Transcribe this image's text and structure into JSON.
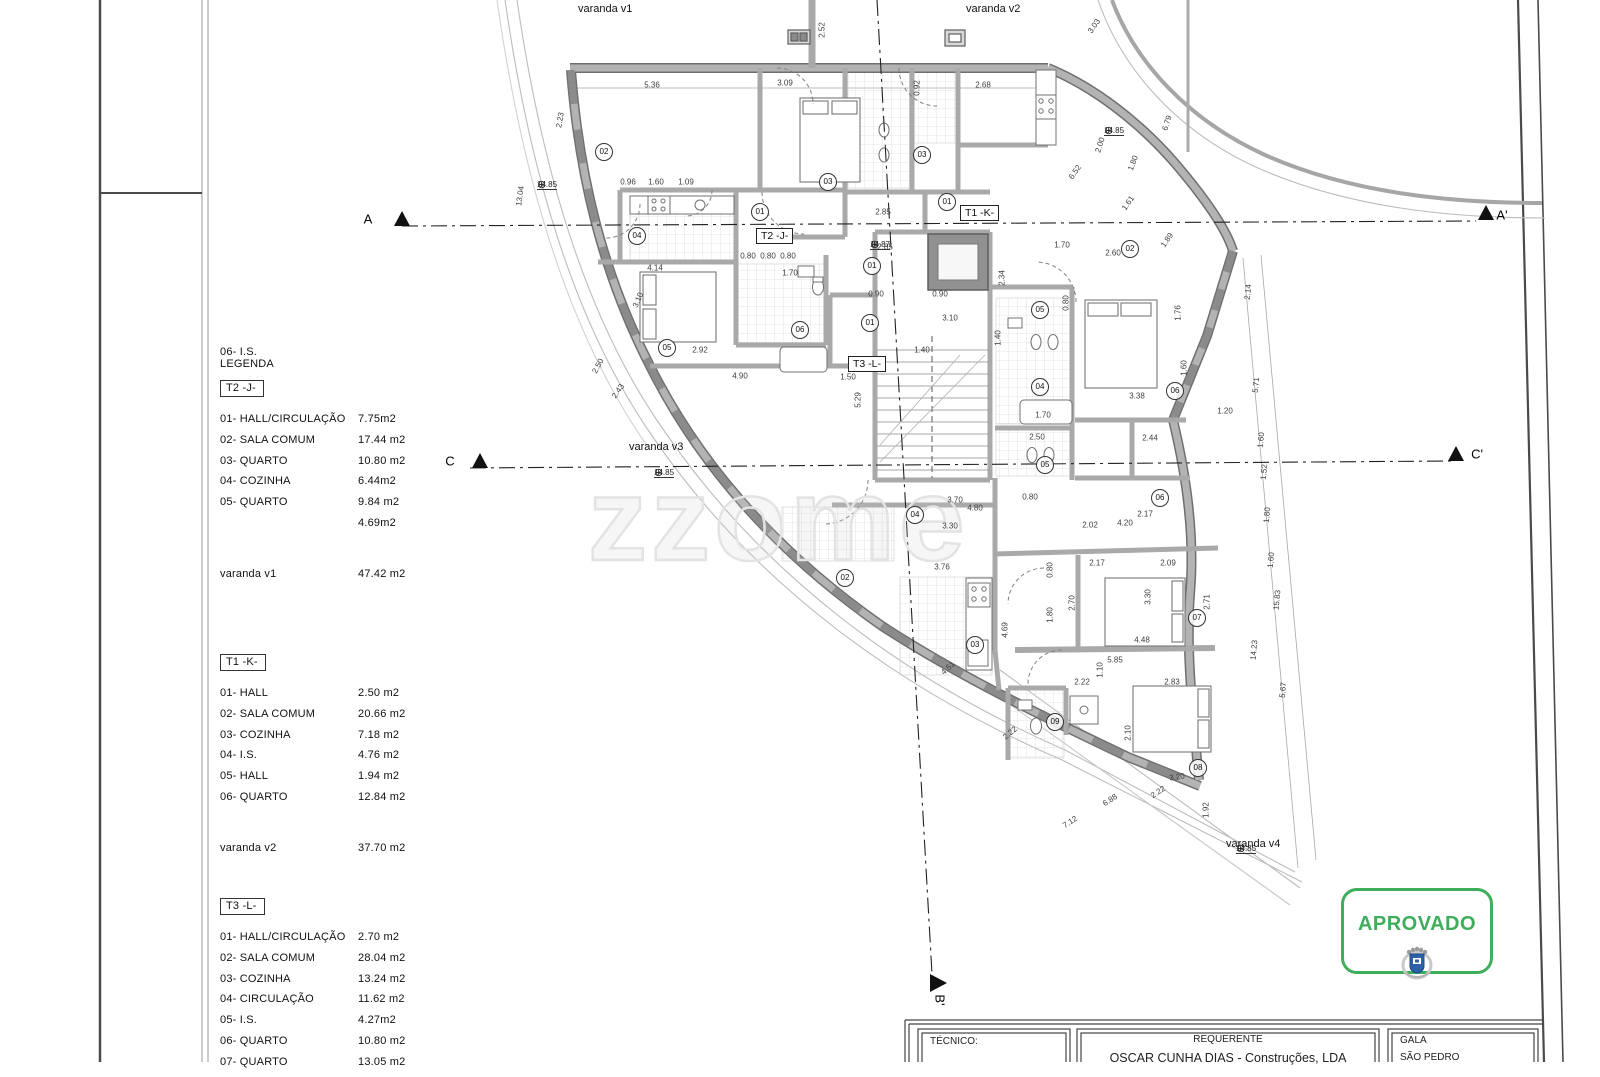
{
  "legend": {
    "pre_note": "06- I.S.",
    "title": "LEGENDA",
    "sections": [
      {
        "tag": "T2 -J-",
        "rows": [
          {
            "label": "01- HALL/CIRCULAÇÃO",
            "value": "7.75m2"
          },
          {
            "label": "02- SALA COMUM",
            "value": "17.44 m2"
          },
          {
            "label": "03- QUARTO",
            "value": "10.80 m2"
          },
          {
            "label": "04- COZINHA",
            "value": "6.44m2"
          },
          {
            "label": "05- QUARTO",
            "value": "9.84 m2"
          },
          {
            "label": "",
            "value": "4.69m2"
          }
        ],
        "varanda": {
          "label": "varanda v1",
          "value": "47.42 m2"
        }
      },
      {
        "tag": "T1 -K-",
        "rows": [
          {
            "label": "01- HALL",
            "value": "2.50 m2"
          },
          {
            "label": "02- SALA COMUM",
            "value": "20.66 m2"
          },
          {
            "label": "03- COZINHA",
            "value": "7.18 m2"
          },
          {
            "label": "04- I.S.",
            "value": "4.76 m2"
          },
          {
            "label": "05- HALL",
            "value": "1.94 m2"
          },
          {
            "label": "06- QUARTO",
            "value": "12.84 m2"
          }
        ],
        "varanda": {
          "label": "varanda v2",
          "value": "37.70 m2"
        }
      },
      {
        "tag": "T3 -L-",
        "rows": [
          {
            "label": "01- HALL/CIRCULAÇÃO",
            "value": "2.70 m2"
          },
          {
            "label": "02- SALA COMUM",
            "value": "28.04 m2"
          },
          {
            "label": "03- COZINHA",
            "value": "13.24 m2"
          },
          {
            "label": "04- CIRCULAÇÃO",
            "value": "11.62 m2"
          },
          {
            "label": "05- I.S.",
            "value": "4.27m2"
          },
          {
            "label": "06- QUARTO",
            "value": "10.80 m2"
          },
          {
            "label": "07- QUARTO",
            "value": "13.05 m2"
          }
        ],
        "varanda": null
      }
    ]
  },
  "plan": {
    "unit_tags": [
      {
        "text": "T2 -J-",
        "x": 756,
        "y": 228
      },
      {
        "text": "T1 -K-",
        "x": 960,
        "y": 205
      },
      {
        "text": "T3 -L-",
        "x": 848,
        "y": 356
      }
    ],
    "balconies": [
      {
        "text": "varanda v1",
        "x": 578,
        "y": 3
      },
      {
        "text": "varanda v2",
        "x": 966,
        "y": 3
      },
      {
        "text": "varanda v3",
        "x": 629,
        "y": 441
      },
      {
        "text": "varanda v4",
        "x": 1226,
        "y": 838
      }
    ],
    "levels": [
      {
        "value": "14.85",
        "x": 545,
        "y": 190
      },
      {
        "value": "14.87",
        "x": 878,
        "y": 250
      },
      {
        "value": "14.85",
        "x": 662,
        "y": 478
      },
      {
        "value": "14.85",
        "x": 1112,
        "y": 136
      },
      {
        "value": "14.85",
        "x": 1244,
        "y": 854
      }
    ],
    "section_markers": [
      {
        "text": "A",
        "x": 368,
        "y": 219,
        "rot": 0
      },
      {
        "text": "A'",
        "x": 1502,
        "y": 215,
        "rot": 0
      },
      {
        "text": "C",
        "x": 450,
        "y": 461,
        "rot": 0
      },
      {
        "text": "C'",
        "x": 1477,
        "y": 454,
        "rot": 0
      },
      {
        "text": "B'",
        "x": 940,
        "y": 1000,
        "rot": 90
      }
    ],
    "rooms": [
      {
        "n": "02",
        "x": 604,
        "y": 152
      },
      {
        "n": "03",
        "x": 828,
        "y": 182
      },
      {
        "n": "03",
        "x": 922,
        "y": 155
      },
      {
        "n": "01",
        "x": 760,
        "y": 212
      },
      {
        "n": "01",
        "x": 947,
        "y": 202
      },
      {
        "n": "01",
        "x": 872,
        "y": 266
      },
      {
        "n": "01",
        "x": 870,
        "y": 323
      },
      {
        "n": "04",
        "x": 637,
        "y": 236
      },
      {
        "n": "05",
        "x": 667,
        "y": 348
      },
      {
        "n": "06",
        "x": 800,
        "y": 330
      },
      {
        "n": "02",
        "x": 1130,
        "y": 249
      },
      {
        "n": "05",
        "x": 1040,
        "y": 310
      },
      {
        "n": "04",
        "x": 1040,
        "y": 387
      },
      {
        "n": "06",
        "x": 1175,
        "y": 391
      },
      {
        "n": "05",
        "x": 1045,
        "y": 465
      },
      {
        "n": "06",
        "x": 1160,
        "y": 498
      },
      {
        "n": "04",
        "x": 915,
        "y": 515
      },
      {
        "n": "02",
        "x": 845,
        "y": 578
      },
      {
        "n": "03",
        "x": 975,
        "y": 645
      },
      {
        "n": "07",
        "x": 1197,
        "y": 618
      },
      {
        "n": "09",
        "x": 1055,
        "y": 722
      },
      {
        "n": "08",
        "x": 1198,
        "y": 768
      }
    ],
    "dimensions": [
      {
        "t": "5.36",
        "x": 652,
        "y": 85,
        "r": 0
      },
      {
        "t": "3.09",
        "x": 785,
        "y": 83,
        "r": 0
      },
      {
        "t": "2.68",
        "x": 983,
        "y": 85,
        "r": 0
      },
      {
        "t": "2.52",
        "x": 822,
        "y": 30,
        "r": -90
      },
      {
        "t": "0.92",
        "x": 917,
        "y": 88,
        "r": -90
      },
      {
        "t": "2.85",
        "x": 883,
        "y": 212,
        "r": 0
      },
      {
        "t": "2.85",
        "x": 885,
        "y": 247,
        "r": 0
      },
      {
        "t": "0.96",
        "x": 628,
        "y": 182,
        "r": 0
      },
      {
        "t": "1.60",
        "x": 656,
        "y": 182,
        "r": 0
      },
      {
        "t": "1.09",
        "x": 686,
        "y": 182,
        "r": 0
      },
      {
        "t": "0.80",
        "x": 748,
        "y": 256,
        "r": 0
      },
      {
        "t": "0.80",
        "x": 768,
        "y": 256,
        "r": 0
      },
      {
        "t": "0.80",
        "x": 788,
        "y": 256,
        "r": 0
      },
      {
        "t": "1.70",
        "x": 790,
        "y": 273,
        "r": 0
      },
      {
        "t": "4.14",
        "x": 655,
        "y": 268,
        "r": 0
      },
      {
        "t": "2.92",
        "x": 700,
        "y": 350,
        "r": 0
      },
      {
        "t": "4.90",
        "x": 740,
        "y": 376,
        "r": 0
      },
      {
        "t": "1.50",
        "x": 848,
        "y": 377,
        "r": 0
      },
      {
        "t": "2.50",
        "x": 598,
        "y": 366,
        "r": -62
      },
      {
        "t": "2.43",
        "x": 618,
        "y": 391,
        "r": -55
      },
      {
        "t": "3.10",
        "x": 638,
        "y": 300,
        "r": -68
      },
      {
        "t": "2.23",
        "x": 560,
        "y": 120,
        "r": -80
      },
      {
        "t": "13.04",
        "x": 520,
        "y": 196,
        "r": -82
      },
      {
        "t": "5.29",
        "x": 858,
        "y": 400,
        "r": -90
      },
      {
        "t": "1.40",
        "x": 922,
        "y": 350,
        "r": 0
      },
      {
        "t": "3.10",
        "x": 950,
        "y": 318,
        "r": 0
      },
      {
        "t": "1.40",
        "x": 998,
        "y": 338,
        "r": -90
      },
      {
        "t": "0.90",
        "x": 876,
        "y": 294,
        "r": 0
      },
      {
        "t": "0.90",
        "x": 940,
        "y": 294,
        "r": 0
      },
      {
        "t": "3.70",
        "x": 955,
        "y": 500,
        "r": 0
      },
      {
        "t": "4.80",
        "x": 975,
        "y": 508,
        "r": 0
      },
      {
        "t": "3.30",
        "x": 950,
        "y": 526,
        "r": 0
      },
      {
        "t": "0.80",
        "x": 1030,
        "y": 497,
        "r": 0
      },
      {
        "t": "2.34",
        "x": 1002,
        "y": 278,
        "r": -90
      },
      {
        "t": "0.80",
        "x": 1066,
        "y": 303,
        "r": -90
      },
      {
        "t": "1.76",
        "x": 1178,
        "y": 313,
        "r": -90
      },
      {
        "t": "1.60",
        "x": 1184,
        "y": 368,
        "r": -90
      },
      {
        "t": "3.38",
        "x": 1137,
        "y": 396,
        "r": 0
      },
      {
        "t": "1.70",
        "x": 1043,
        "y": 415,
        "r": 0
      },
      {
        "t": "1.20",
        "x": 1225,
        "y": 411,
        "r": 0
      },
      {
        "t": "2.44",
        "x": 1150,
        "y": 438,
        "r": 0
      },
      {
        "t": "2.50",
        "x": 1037,
        "y": 437,
        "r": 0
      },
      {
        "t": "2.17",
        "x": 1145,
        "y": 514,
        "r": 0
      },
      {
        "t": "4.20",
        "x": 1125,
        "y": 523,
        "r": 0
      },
      {
        "t": "2.02",
        "x": 1090,
        "y": 525,
        "r": 0
      },
      {
        "t": "3.76",
        "x": 942,
        "y": 567,
        "r": 0
      },
      {
        "t": "2.17",
        "x": 1097,
        "y": 563,
        "r": 0
      },
      {
        "t": "2.09",
        "x": 1168,
        "y": 563,
        "r": 0
      },
      {
        "t": "3.30",
        "x": 1148,
        "y": 597,
        "r": -90
      },
      {
        "t": "2.70",
        "x": 1072,
        "y": 603,
        "r": -90
      },
      {
        "t": "1.80",
        "x": 1050,
        "y": 615,
        "r": -90
      },
      {
        "t": "0.80",
        "x": 1050,
        "y": 570,
        "r": -90
      },
      {
        "t": "4.48",
        "x": 1142,
        "y": 640,
        "r": 0
      },
      {
        "t": "5.85",
        "x": 1115,
        "y": 660,
        "r": 0
      },
      {
        "t": "2.22",
        "x": 1082,
        "y": 682,
        "r": 0
      },
      {
        "t": "2.83",
        "x": 1172,
        "y": 682,
        "r": 0
      },
      {
        "t": "1.10",
        "x": 1100,
        "y": 670,
        "r": -90
      },
      {
        "t": "2.10",
        "x": 1128,
        "y": 733,
        "r": -90
      },
      {
        "t": "3.20",
        "x": 1177,
        "y": 777,
        "r": -8
      },
      {
        "t": "2.71",
        "x": 1207,
        "y": 602,
        "r": -90
      },
      {
        "t": "4.51",
        "x": 948,
        "y": 668,
        "r": -42
      },
      {
        "t": "4.69",
        "x": 1005,
        "y": 630,
        "r": -90
      },
      {
        "t": "2.22",
        "x": 1010,
        "y": 733,
        "r": -40
      },
      {
        "t": "6.52",
        "x": 1075,
        "y": 172,
        "r": -55
      },
      {
        "t": "2.00",
        "x": 1100,
        "y": 145,
        "r": -72
      },
      {
        "t": "1.80",
        "x": 1133,
        "y": 163,
        "r": -70
      },
      {
        "t": "1.61",
        "x": 1128,
        "y": 203,
        "r": -55
      },
      {
        "t": "1.89",
        "x": 1167,
        "y": 240,
        "r": -55
      },
      {
        "t": "3.03",
        "x": 1094,
        "y": 26,
        "r": -55
      },
      {
        "t": "6.79",
        "x": 1167,
        "y": 123,
        "r": -72
      },
      {
        "t": "2.60",
        "x": 1113,
        "y": 253,
        "r": 0
      },
      {
        "t": "1.70",
        "x": 1062,
        "y": 245,
        "r": 0
      },
      {
        "t": "2.14",
        "x": 1248,
        "y": 292,
        "r": -85
      },
      {
        "t": "5.71",
        "x": 1256,
        "y": 385,
        "r": -85
      },
      {
        "t": "1.60",
        "x": 1261,
        "y": 440,
        "r": -85
      },
      {
        "t": "1.52",
        "x": 1264,
        "y": 472,
        "r": -85
      },
      {
        "t": "1.80",
        "x": 1267,
        "y": 515,
        "r": -85
      },
      {
        "t": "1.60",
        "x": 1271,
        "y": 560,
        "r": -85
      },
      {
        "t": "15.83",
        "x": 1277,
        "y": 600,
        "r": -85
      },
      {
        "t": "14.23",
        "x": 1254,
        "y": 650,
        "r": -85
      },
      {
        "t": "5.67",
        "x": 1283,
        "y": 690,
        "r": -85
      },
      {
        "t": "6.88",
        "x": 1110,
        "y": 800,
        "r": -33
      },
      {
        "t": "7.12",
        "x": 1070,
        "y": 822,
        "r": -33
      },
      {
        "t": "1.92",
        "x": 1206,
        "y": 810,
        "r": -90
      },
      {
        "t": "2.22",
        "x": 1158,
        "y": 792,
        "r": -33
      }
    ]
  },
  "watermark": {
    "text": "zzome"
  },
  "stamp": {
    "label": "APROVADO"
  },
  "title_block": {
    "tecnico_label": "TÉCNICO:",
    "requerente_label": "REQUERENTE",
    "requerente_name": "OSCAR CUNHA DIAS - Construções, LDA",
    "local_line1": "GALA",
    "local_line2": "SÃO PEDRO"
  },
  "colors": {
    "stamp_green": "#3fae5c",
    "crest_blue": "#2e62a6",
    "wall_gray": "#b3b3b3",
    "wall_edge": "#6f6f6f"
  }
}
